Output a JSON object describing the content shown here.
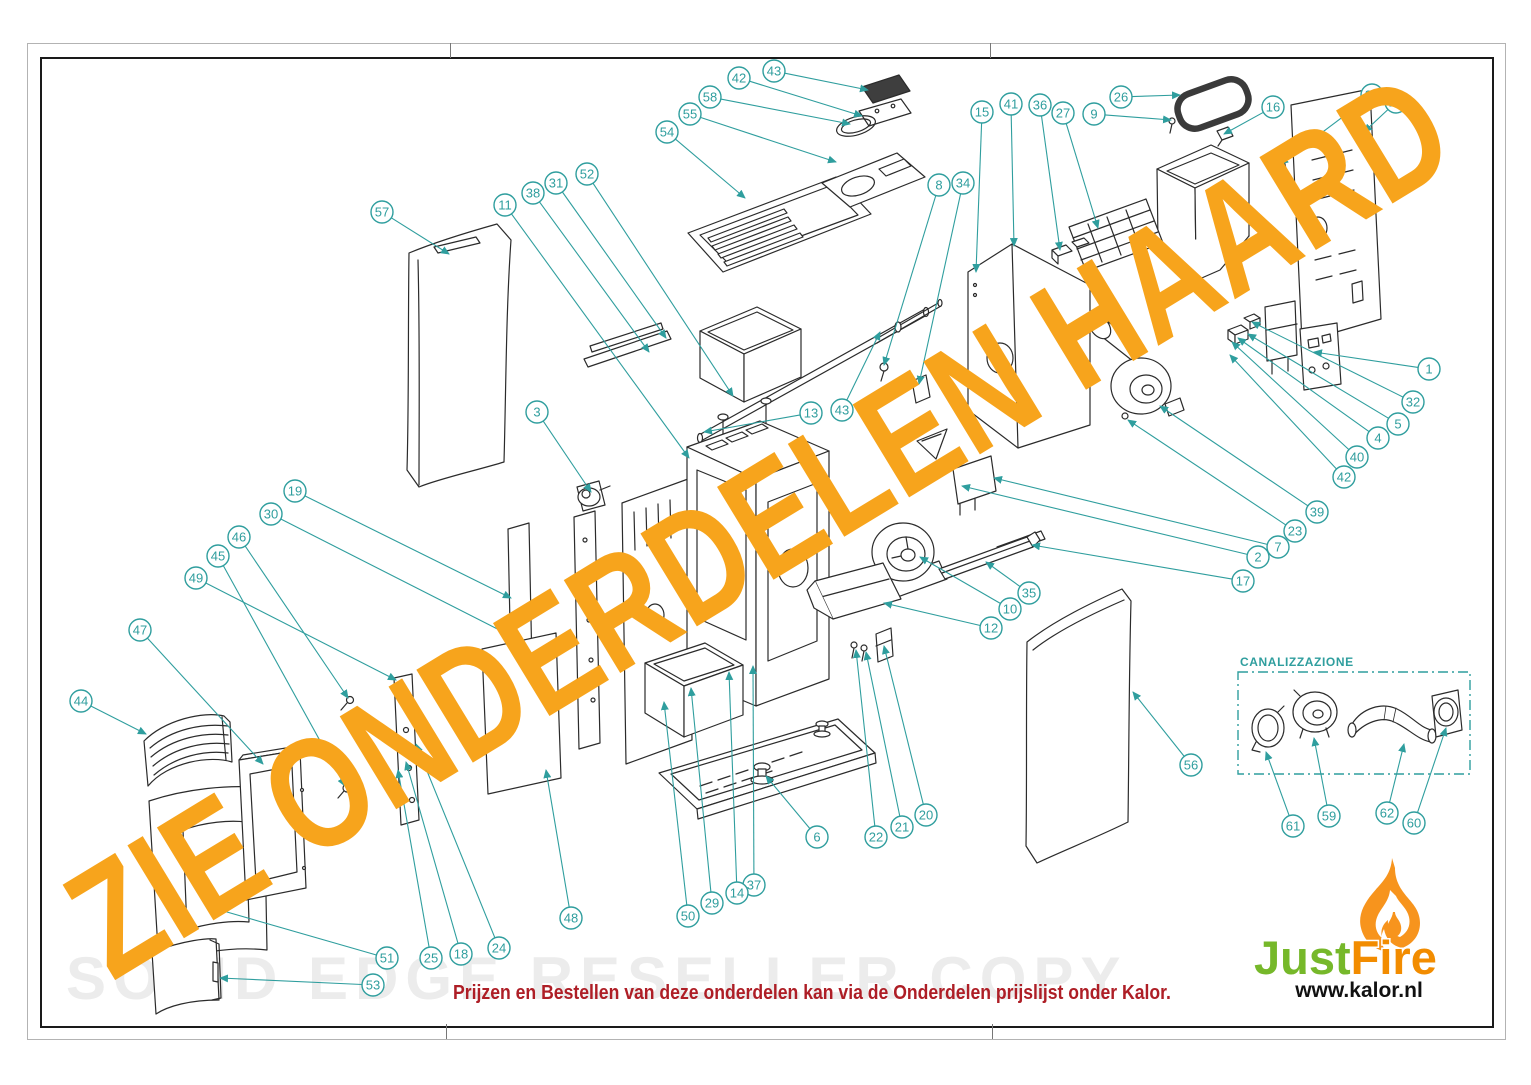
{
  "page": {
    "watermark_diagonal": "ZIE ONDERDELEN HAARD",
    "watermark_bottom": "SOLID EDGE RESELLER COPY",
    "footer_note": "Prijzen en Bestellen van deze onderdelen kan via de Onderdelen prijslijst onder Kalor.",
    "colors": {
      "callout": "#2F9E9E",
      "watermark": "#F7A41C",
      "line": "#2b2b2b",
      "footer_red": "#AE1E26",
      "logo_green": "#76B82A",
      "logo_orange": "#F28C00",
      "flame_orange": "#F7941D"
    }
  },
  "logo": {
    "brand_green": "Just",
    "brand_orange": "Fire",
    "url": "www.kalor.nl"
  },
  "canalizzazione": {
    "label": "CANALIZZAZIONE"
  },
  "callouts": [
    {
      "n": "54",
      "cx": 667,
      "cy": 132,
      "tx": 745,
      "ty": 198
    },
    {
      "n": "55",
      "cx": 690,
      "cy": 114,
      "tx": 836,
      "ty": 162
    },
    {
      "n": "58",
      "cx": 710,
      "cy": 97,
      "tx": 850,
      "ty": 124
    },
    {
      "n": "42",
      "cx": 739,
      "cy": 78,
      "tx": 862,
      "ty": 116
    },
    {
      "n": "43",
      "cx": 774,
      "cy": 71,
      "tx": 868,
      "ty": 90
    },
    {
      "n": "57",
      "cx": 382,
      "cy": 212,
      "tx": 449,
      "ty": 254
    },
    {
      "n": "11",
      "cx": 505,
      "cy": 205,
      "tx": 689,
      "ty": 458
    },
    {
      "n": "38",
      "cx": 533,
      "cy": 193,
      "tx": 649,
      "ty": 352
    },
    {
      "n": "31",
      "cx": 556,
      "cy": 183,
      "tx": 666,
      "ty": 338
    },
    {
      "n": "52",
      "cx": 587,
      "cy": 174,
      "tx": 733,
      "ty": 396
    },
    {
      "n": "3",
      "cx": 537,
      "cy": 412,
      "tx": 591,
      "ty": 492
    },
    {
      "n": "19",
      "cx": 295,
      "cy": 491,
      "tx": 511,
      "ty": 598
    },
    {
      "n": "30",
      "cx": 271,
      "cy": 514,
      "tx": 519,
      "ty": 640
    },
    {
      "n": "46",
      "cx": 239,
      "cy": 537,
      "tx": 348,
      "ty": 698
    },
    {
      "n": "45",
      "cx": 218,
      "cy": 556,
      "tx": 345,
      "ty": 786
    },
    {
      "n": "49",
      "cx": 196,
      "cy": 578,
      "tx": 396,
      "ty": 680
    },
    {
      "n": "47",
      "cx": 140,
      "cy": 630,
      "tx": 263,
      "ty": 764
    },
    {
      "n": "44",
      "cx": 81,
      "cy": 701,
      "tx": 146,
      "ty": 734
    },
    {
      "n": "15",
      "cx": 982,
      "cy": 112,
      "tx": 976,
      "ty": 272
    },
    {
      "n": "41",
      "cx": 1011,
      "cy": 104,
      "tx": 1014,
      "ty": 246
    },
    {
      "n": "36",
      "cx": 1040,
      "cy": 105,
      "tx": 1060,
      "ty": 250
    },
    {
      "n": "27",
      "cx": 1063,
      "cy": 113,
      "tx": 1098,
      "ty": 228
    },
    {
      "n": "9",
      "cx": 1094,
      "cy": 114,
      "tx": 1171,
      "ty": 120
    },
    {
      "n": "26",
      "cx": 1121,
      "cy": 97,
      "tx": 1180,
      "ty": 95
    },
    {
      "n": "16",
      "cx": 1273,
      "cy": 107,
      "tx": 1224,
      "ty": 134
    },
    {
      "n": "33",
      "cx": 1372,
      "cy": 95,
      "tx": 1280,
      "ty": 164
    },
    {
      "n": "28",
      "cx": 1396,
      "cy": 102,
      "tx": 1364,
      "ty": 132
    },
    {
      "n": "8",
      "cx": 939,
      "cy": 185,
      "tx": 884,
      "ty": 365
    },
    {
      "n": "34",
      "cx": 963,
      "cy": 183,
      "tx": 919,
      "ty": 384
    },
    {
      "n": "13",
      "cx": 811,
      "cy": 413,
      "tx": 704,
      "ty": 432
    },
    {
      "n": "43",
      "cx": 842,
      "cy": 410,
      "tx": 880,
      "ty": 332
    },
    {
      "n": "1",
      "cx": 1429,
      "cy": 369,
      "tx": 1314,
      "ty": 352
    },
    {
      "n": "32",
      "cx": 1413,
      "cy": 402,
      "tx": 1252,
      "ty": 322
    },
    {
      "n": "5",
      "cx": 1398,
      "cy": 424,
      "tx": 1248,
      "ty": 334
    },
    {
      "n": "4",
      "cx": 1378,
      "cy": 438,
      "tx": 1238,
      "ty": 338
    },
    {
      "n": "40",
      "cx": 1357,
      "cy": 457,
      "tx": 1232,
      "ty": 342
    },
    {
      "n": "42",
      "cx": 1344,
      "cy": 477,
      "tx": 1230,
      "ty": 355
    },
    {
      "n": "39",
      "cx": 1317,
      "cy": 512,
      "tx": 1160,
      "ty": 406
    },
    {
      "n": "23",
      "cx": 1295,
      "cy": 531,
      "tx": 1128,
      "ty": 420
    },
    {
      "n": "7",
      "cx": 1278,
      "cy": 547,
      "tx": 994,
      "ty": 478
    },
    {
      "n": "2",
      "cx": 1258,
      "cy": 557,
      "tx": 962,
      "ty": 486
    },
    {
      "n": "17",
      "cx": 1243,
      "cy": 581,
      "tx": 1032,
      "ty": 545
    },
    {
      "n": "35",
      "cx": 1029,
      "cy": 593,
      "tx": 986,
      "ty": 562
    },
    {
      "n": "10",
      "cx": 1010,
      "cy": 609,
      "tx": 920,
      "ty": 557
    },
    {
      "n": "12",
      "cx": 991,
      "cy": 628,
      "tx": 884,
      "ty": 603
    },
    {
      "n": "56",
      "cx": 1191,
      "cy": 765,
      "tx": 1133,
      "ty": 692
    },
    {
      "n": "6",
      "cx": 817,
      "cy": 837,
      "tx": 766,
      "ty": 776
    },
    {
      "n": "22",
      "cx": 876,
      "cy": 837,
      "tx": 856,
      "ty": 650
    },
    {
      "n": "21",
      "cx": 902,
      "cy": 827,
      "tx": 866,
      "ty": 652
    },
    {
      "n": "20",
      "cx": 926,
      "cy": 815,
      "tx": 884,
      "ty": 646
    },
    {
      "n": "37",
      "cx": 754,
      "cy": 885,
      "tx": 753,
      "ty": 666
    },
    {
      "n": "14",
      "cx": 737,
      "cy": 893,
      "tx": 729,
      "ty": 672
    },
    {
      "n": "29",
      "cx": 712,
      "cy": 903,
      "tx": 691,
      "ty": 688
    },
    {
      "n": "50",
      "cx": 688,
      "cy": 916,
      "tx": 664,
      "ty": 702
    },
    {
      "n": "48",
      "cx": 571,
      "cy": 918,
      "tx": 546,
      "ty": 770
    },
    {
      "n": "24",
      "cx": 499,
      "cy": 948,
      "tx": 416,
      "ty": 744
    },
    {
      "n": "18",
      "cx": 461,
      "cy": 954,
      "tx": 406,
      "ty": 762
    },
    {
      "n": "25",
      "cx": 431,
      "cy": 958,
      "tx": 398,
      "ty": 770
    },
    {
      "n": "51",
      "cx": 387,
      "cy": 958,
      "tx": 213,
      "ty": 908
    },
    {
      "n": "53",
      "cx": 373,
      "cy": 985,
      "tx": 220,
      "ty": 978
    },
    {
      "n": "61",
      "cx": 1293,
      "cy": 826,
      "tx": 1266,
      "ty": 752
    },
    {
      "n": "59",
      "cx": 1329,
      "cy": 816,
      "tx": 1314,
      "ty": 738
    },
    {
      "n": "62",
      "cx": 1387,
      "cy": 813,
      "tx": 1404,
      "ty": 744
    },
    {
      "n": "60",
      "cx": 1414,
      "cy": 823,
      "tx": 1446,
      "ty": 728
    }
  ]
}
